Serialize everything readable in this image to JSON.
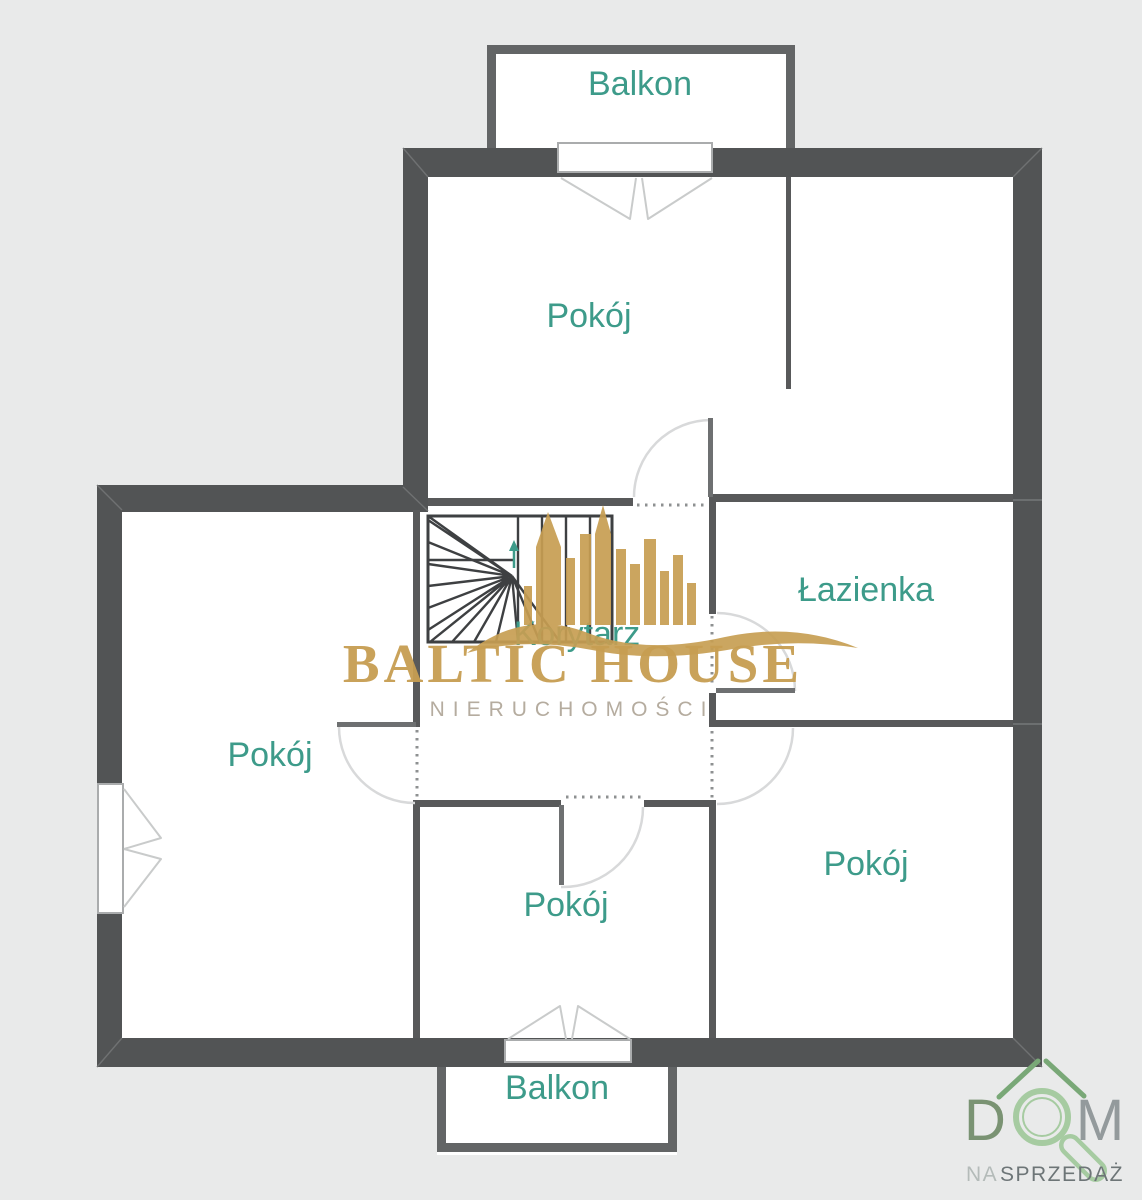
{
  "plan": {
    "background_color": "#e9eaea",
    "floor_color": "#ffffff",
    "wall_color": "#525455",
    "room_label_color": "#3d9b8a",
    "rooms": {
      "balkon_top": "Balkon",
      "pokoj_top": "Pokój",
      "lazienka": "Łazienka",
      "korytarz": "Korytarz",
      "pokoj_left": "Pokój",
      "pokoj_middle": "Pokój",
      "pokoj_right": "Pokój",
      "balkon_bottom": "Balkon"
    },
    "icons": {
      "stairs": "winder-staircase-icon",
      "door": "quarter-circle-door-swing-icon",
      "window": "double-casement-window-icon",
      "balcony_door": "double-leaf-balcony-door-icon"
    }
  },
  "watermark": {
    "title": "BALTIC HOUSE",
    "subtitle": "NIERUCHOMOŚCI",
    "color": "#c79e52",
    "subtitle_color": "#b5ac9f",
    "icon": "city-skyline-wave-icon"
  },
  "corner_logo": {
    "letter_d": "D",
    "letter_m": "M",
    "tagline_na": "NA",
    "tagline_sprzedaz": "SPRZEDAŻ",
    "icon": "house-roof-magnifier-icon",
    "green_dark": "#7a9373",
    "green_light": "#a6cba1",
    "grey": "#939a9c",
    "tagline_light": "#b4bbb9",
    "tagline_dark": "#6d7577"
  }
}
